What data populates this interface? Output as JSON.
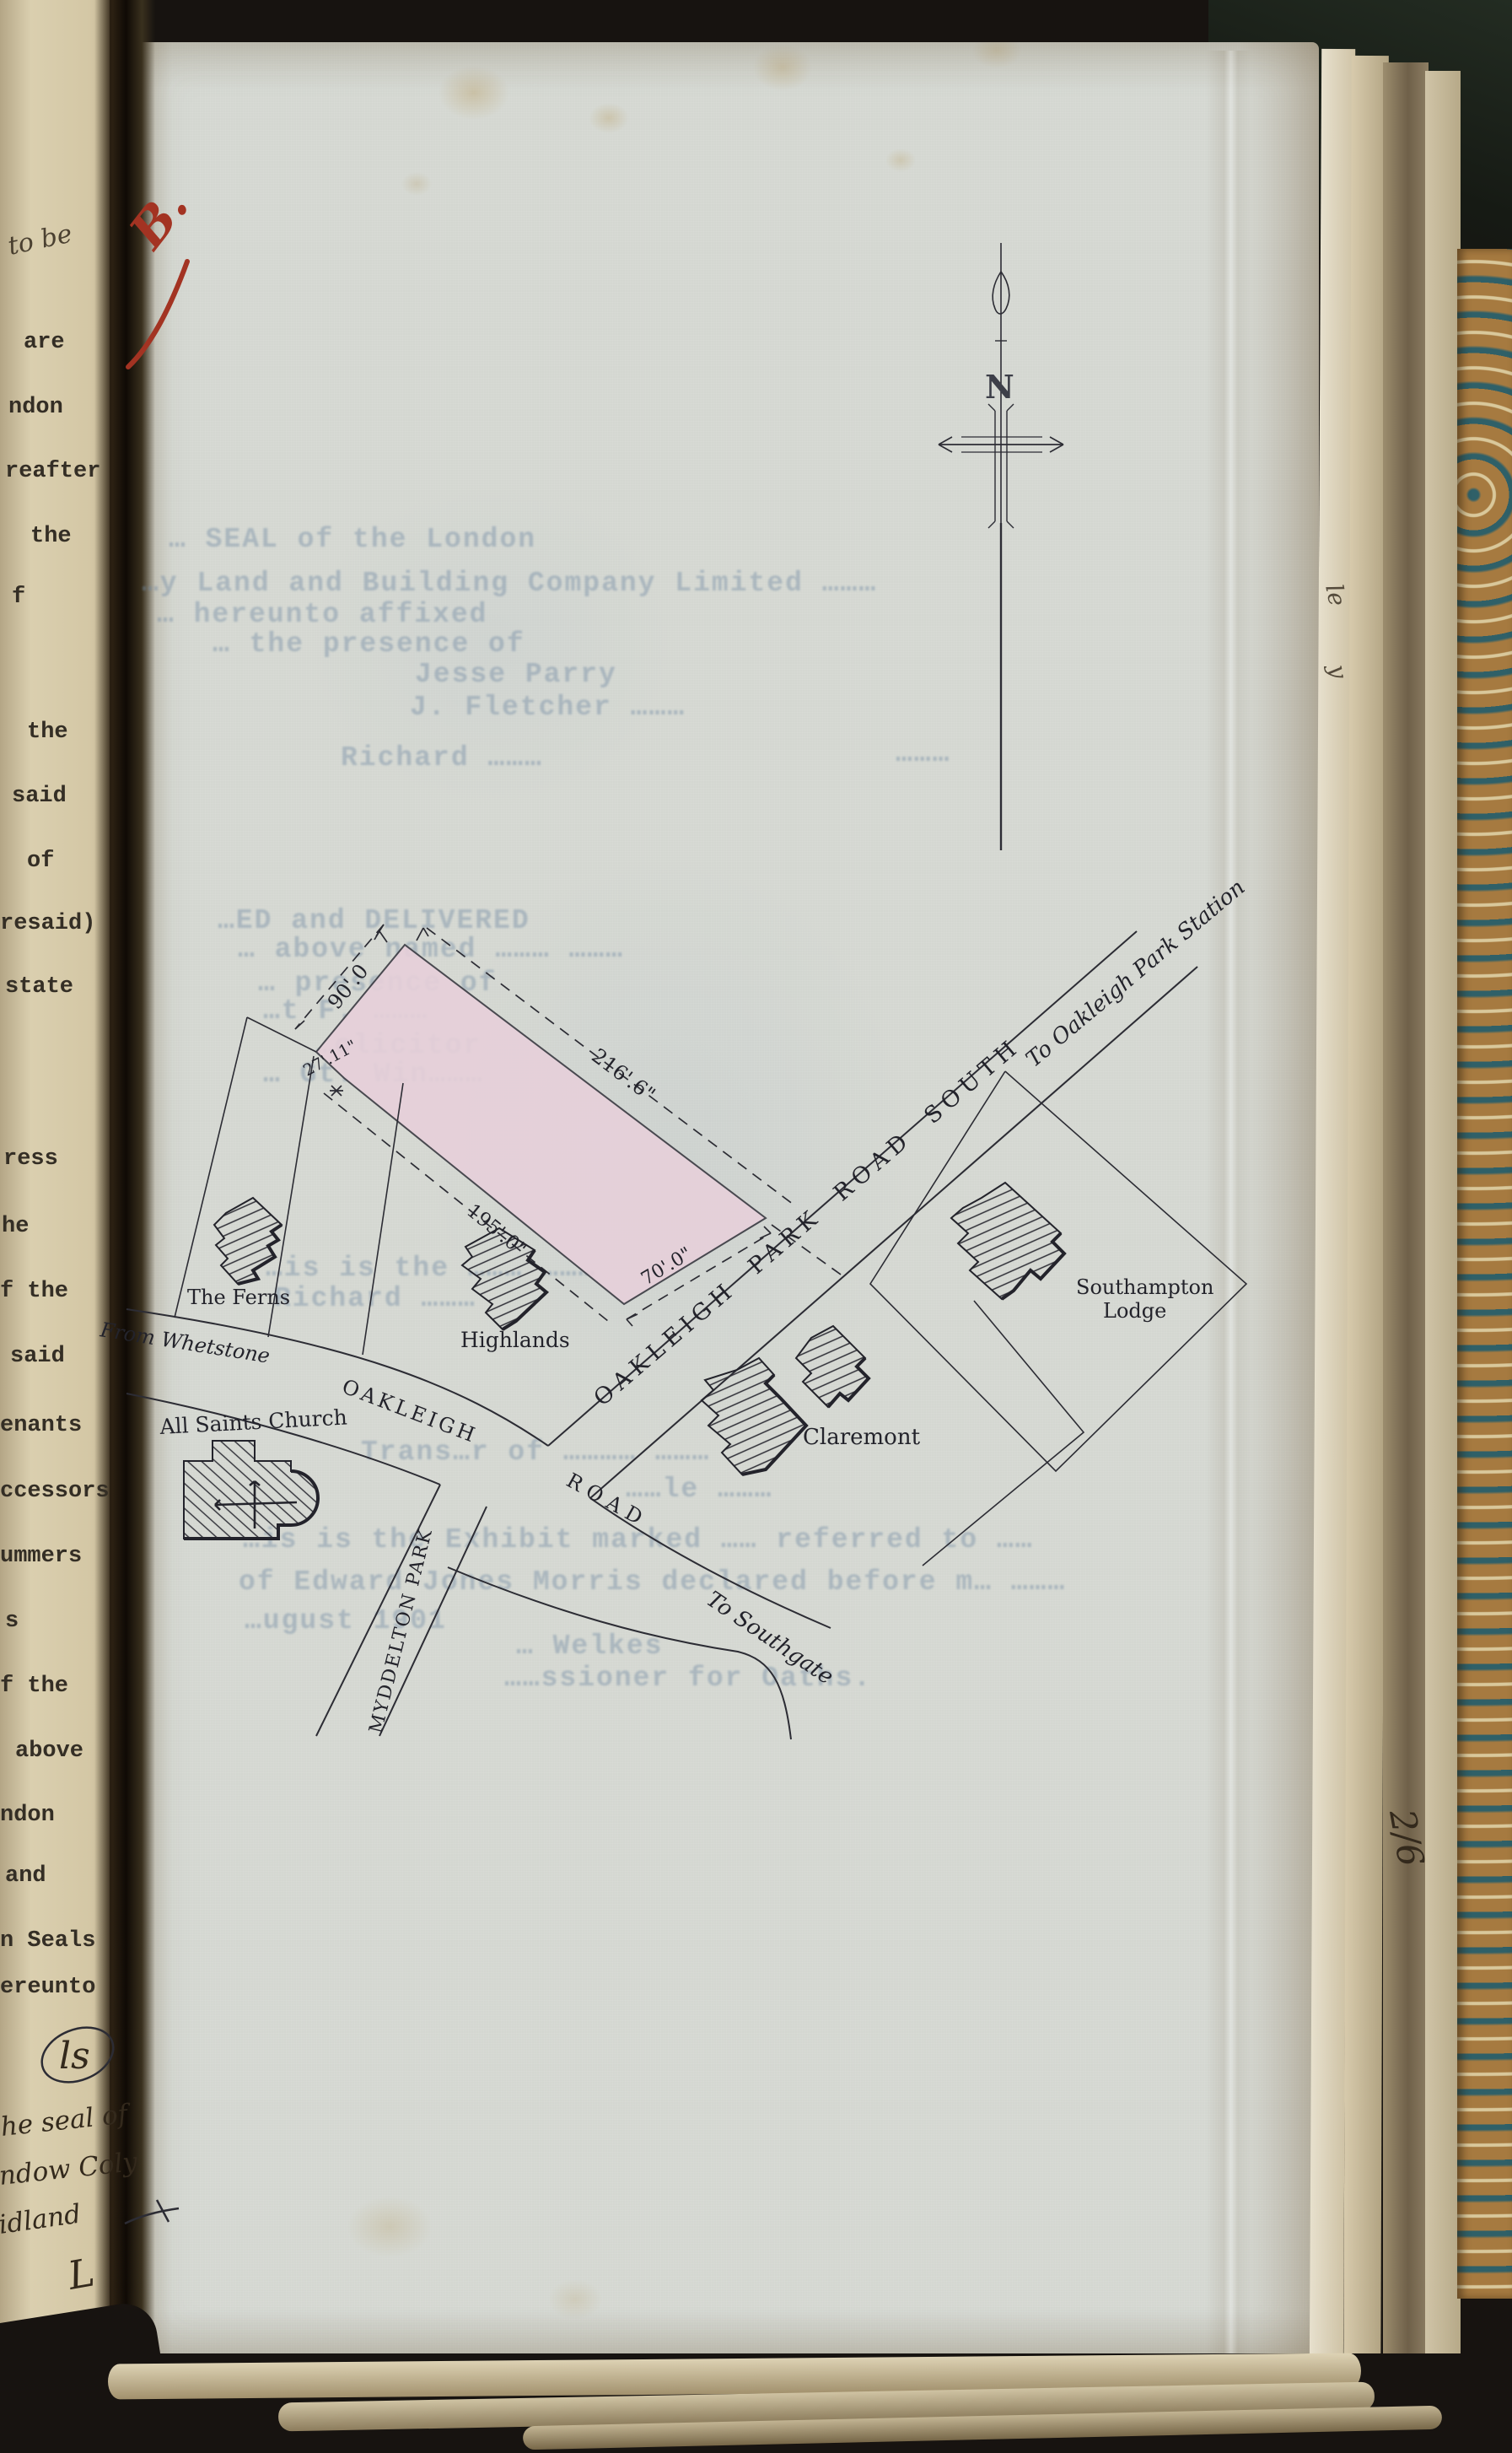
{
  "left_page": {
    "pencil_note": "to be",
    "typed_fragments": {
      "f1": "are",
      "f2": "ndon",
      "f3": "reafter",
      "f4": "the",
      "f5": "f",
      "f6": "the",
      "f7": "said",
      "f8": "of",
      "f9": "resaid)",
      "f10": "state",
      "f11": "ress",
      "f12": "he",
      "f13": "f the",
      "f14": "said",
      "f15": "enants",
      "f16": "ccessors",
      "f17": "ummers",
      "f18": "s",
      "f19": "f the",
      "f20": "above",
      "f21": "ndon",
      "f22": "and",
      "f23": "n Seals",
      "f24": "ereunto"
    },
    "handwriting": {
      "monogram": "ls",
      "line1": "he seal of",
      "line2": "ndow Coly",
      "line3": "idland",
      "line4": "L"
    }
  },
  "page": {
    "red_mark": "B.",
    "edge_note": "2/6",
    "edge_scribble_1": "le",
    "edge_scribble_2": "y",
    "compass_north": "N"
  },
  "map": {
    "roads": {
      "oakleigh_park_road_south": "OAKLEIGH PARK ROAD SOUTH",
      "oakleigh": "OAKLEIGH",
      "road": "ROAD",
      "myddelton_park": "MYDDELTON PARK"
    },
    "directions": {
      "to_station": "To Oakleigh Park Station",
      "to_southgate": "To Southgate",
      "from_whetstone": "From Whetstone"
    },
    "buildings": {
      "the_ferns": "The Ferns",
      "highlands": "Highlands",
      "claremont": "Claremont",
      "southampton_1": "Southampton",
      "southampton_2": "Lodge",
      "church": "All Saints Church"
    },
    "dimensions": {
      "nw": "90'.0",
      "ne": "216'.6\"",
      "w": "27'.11\"",
      "sw": "195'.0\"",
      "frontage": "70'.0\""
    },
    "plot_color": "#e7d0da"
  },
  "faint_text": {
    "a1": "… SEAL of the London",
    "a2": "…y Land and Building Company Limited ………",
    "a3": "… hereunto affixed",
    "a4": "… the presence of",
    "a5": "Jesse Parry",
    "a6": "J. Fletcher ………",
    "b1": "Richard ………",
    "b2": "………",
    "c1": "…ED and DELIVERED",
    "c2": "… above named ……… ………",
    "c3": "… presence of",
    "c4": "…t F. ………",
    "c5": "…olicitor",
    "c6": "… Gt. Win………",
    "e1": "…is is the ……… ………",
    "e2": "Richard ………",
    "f1": "Trans…r of ………… ………",
    "f2": "……le ………",
    "g1": "…is is the Exhibit marked …… referred to ……",
    "g2": "of Edward Jones Morris declared before m… ………",
    "g3": "…ugust 1901",
    "h1": "… Welkes",
    "h2": "……ssioner for Oaths."
  }
}
